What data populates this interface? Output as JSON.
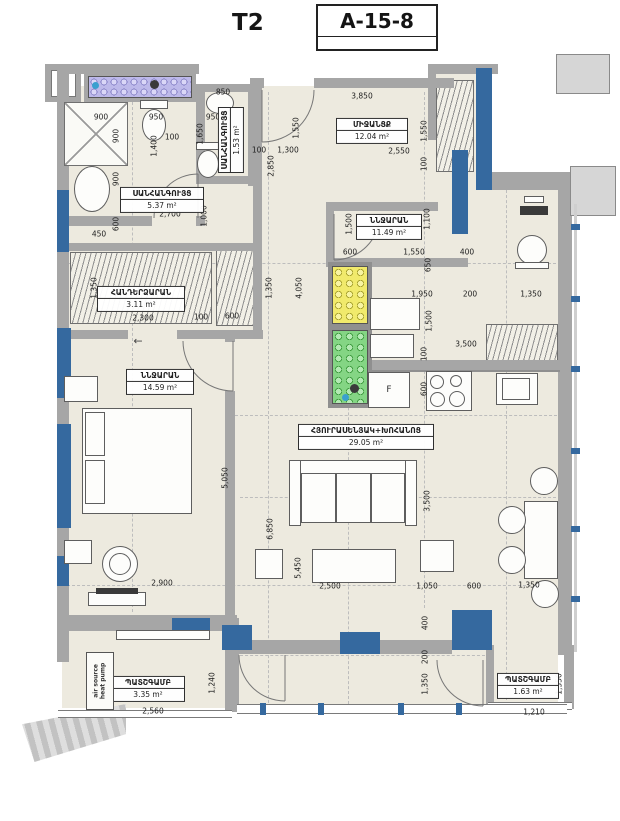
{
  "header": {
    "plan_type": "T2",
    "unit_number": "A-15-8"
  },
  "rooms": [
    {
      "name": "ՍԱՆՀԱՆԳՈՒՅՑ",
      "area": "5.37 m²",
      "x": 162,
      "y": 200,
      "w": 84
    },
    {
      "name": "ՍԱՆՀԱՆԳՈՒՅՑ",
      "area": "1.53 m²",
      "x": 231,
      "y": 140,
      "w": 66,
      "v": 1
    },
    {
      "name": "ՄԻՋԱՆՑՔ",
      "area": "12.04 m²",
      "x": 372,
      "y": 131,
      "w": 72
    },
    {
      "name": "ՆՆՋԱՐԱՆ",
      "area": "11.49 m²",
      "x": 389,
      "y": 227,
      "w": 66
    },
    {
      "name": "ՀԱՆԴԵՐՁԱՐԱՆ",
      "area": "3.11 m²",
      "x": 141,
      "y": 299,
      "w": 88
    },
    {
      "name": "ՆՆՋԱՐԱՆ",
      "area": "14.59 m²",
      "x": 160,
      "y": 382,
      "w": 68
    },
    {
      "name": "ՀՅՈՒՐԱՍԵՆՅԱԿ+ԽՈՀԱՆՈՑ",
      "area": "29.05 m²",
      "x": 366,
      "y": 437,
      "w": 136
    },
    {
      "name": "ՊԱՏՇԳԱՄԲ",
      "area": "3.35 m²",
      "x": 148,
      "y": 689,
      "w": 74
    },
    {
      "name": "ՊԱՏՇԳԱՄԲ",
      "area": "1.63 m²",
      "x": 528,
      "y": 686,
      "w": 62
    }
  ],
  "dimensions": [
    {
      "t": "850",
      "x": 223,
      "y": 92
    },
    {
      "t": "900",
      "x": 101,
      "y": 117
    },
    {
      "t": "950",
      "x": 156,
      "y": 117
    },
    {
      "t": "950",
      "x": 213,
      "y": 117
    },
    {
      "t": "900",
      "x": 116,
      "y": 136,
      "v": 1
    },
    {
      "t": "1,400",
      "x": 154,
      "y": 146,
      "v": 1
    },
    {
      "t": "100",
      "x": 172,
      "y": 137
    },
    {
      "t": "1,650",
      "x": 200,
      "y": 134,
      "v": 1
    },
    {
      "t": "100",
      "x": 259,
      "y": 150
    },
    {
      "t": "1,300",
      "x": 288,
      "y": 150
    },
    {
      "t": "2,850",
      "x": 271,
      "y": 166,
      "v": 1
    },
    {
      "t": "1,550",
      "x": 296,
      "y": 128,
      "v": 1
    },
    {
      "t": "3,850",
      "x": 362,
      "y": 96
    },
    {
      "t": "2,550",
      "x": 399,
      "y": 151
    },
    {
      "t": "1,550",
      "x": 424,
      "y": 131,
      "v": 1
    },
    {
      "t": "100",
      "x": 424,
      "y": 164,
      "v": 1
    },
    {
      "t": "1,100",
      "x": 427,
      "y": 219,
      "v": 1
    },
    {
      "t": "1,500",
      "x": 349,
      "y": 224,
      "v": 1
    },
    {
      "t": "600",
      "x": 350,
      "y": 252
    },
    {
      "t": "1,550",
      "x": 414,
      "y": 252
    },
    {
      "t": "400",
      "x": 467,
      "y": 252
    },
    {
      "t": "650",
      "x": 428,
      "y": 265,
      "v": 1
    },
    {
      "t": "1,950",
      "x": 422,
      "y": 294
    },
    {
      "t": "200",
      "x": 470,
      "y": 294
    },
    {
      "t": "1,350",
      "x": 531,
      "y": 294
    },
    {
      "t": "1,500",
      "x": 429,
      "y": 321,
      "v": 1
    },
    {
      "t": "3,500",
      "x": 466,
      "y": 344
    },
    {
      "t": "100",
      "x": 424,
      "y": 354,
      "v": 1
    },
    {
      "t": "600",
      "x": 424,
      "y": 389,
      "v": 1
    },
    {
      "t": "900",
      "x": 116,
      "y": 179,
      "v": 1
    },
    {
      "t": "2,700",
      "x": 170,
      "y": 214
    },
    {
      "t": "1,000",
      "x": 204,
      "y": 216,
      "v": 1
    },
    {
      "t": "600",
      "x": 116,
      "y": 224,
      "v": 1
    },
    {
      "t": "450",
      "x": 99,
      "y": 234
    },
    {
      "t": "1,350",
      "x": 94,
      "y": 288,
      "v": 1
    },
    {
      "t": "2,300",
      "x": 143,
      "y": 318
    },
    {
      "t": "100",
      "x": 201,
      "y": 317
    },
    {
      "t": "600",
      "x": 232,
      "y": 316
    },
    {
      "t": "1,350",
      "x": 269,
      "y": 288,
      "v": 1
    },
    {
      "t": "4,050",
      "x": 299,
      "y": 288,
      "v": 1
    },
    {
      "t": "5,050",
      "x": 225,
      "y": 478,
      "v": 1
    },
    {
      "t": "3,500",
      "x": 427,
      "y": 501,
      "v": 1
    },
    {
      "t": "2,900",
      "x": 162,
      "y": 583
    },
    {
      "t": "6,850",
      "x": 270,
      "y": 529,
      "v": 1
    },
    {
      "t": "5,450",
      "x": 298,
      "y": 568,
      "v": 1
    },
    {
      "t": "2,500",
      "x": 330,
      "y": 586
    },
    {
      "t": "1,050",
      "x": 427,
      "y": 586
    },
    {
      "t": "600",
      "x": 474,
      "y": 586
    },
    {
      "t": "1,350",
      "x": 529,
      "y": 585
    },
    {
      "t": "400",
      "x": 425,
      "y": 623,
      "v": 1
    },
    {
      "t": "200",
      "x": 425,
      "y": 657,
      "v": 1
    },
    {
      "t": "1,350",
      "x": 425,
      "y": 684,
      "v": 1
    },
    {
      "t": "1,240",
      "x": 212,
      "y": 683,
      "v": 1
    },
    {
      "t": "2,560",
      "x": 153,
      "y": 711
    },
    {
      "t": "1,350",
      "x": 559,
      "y": 684,
      "v": 1
    },
    {
      "t": "1,210",
      "x": 534,
      "y": 712
    }
  ],
  "annotations": {
    "fridge_label": "F",
    "heat_pump_line1": "air source",
    "heat_pump_line2": "heat pump",
    "door_arrow": "←"
  },
  "colors": {
    "structure_blue": "#35699f",
    "shaft_purple": "#bdb9ea",
    "shaft_yellow": "#f1ea6c",
    "shaft_green": "#84d584"
  }
}
